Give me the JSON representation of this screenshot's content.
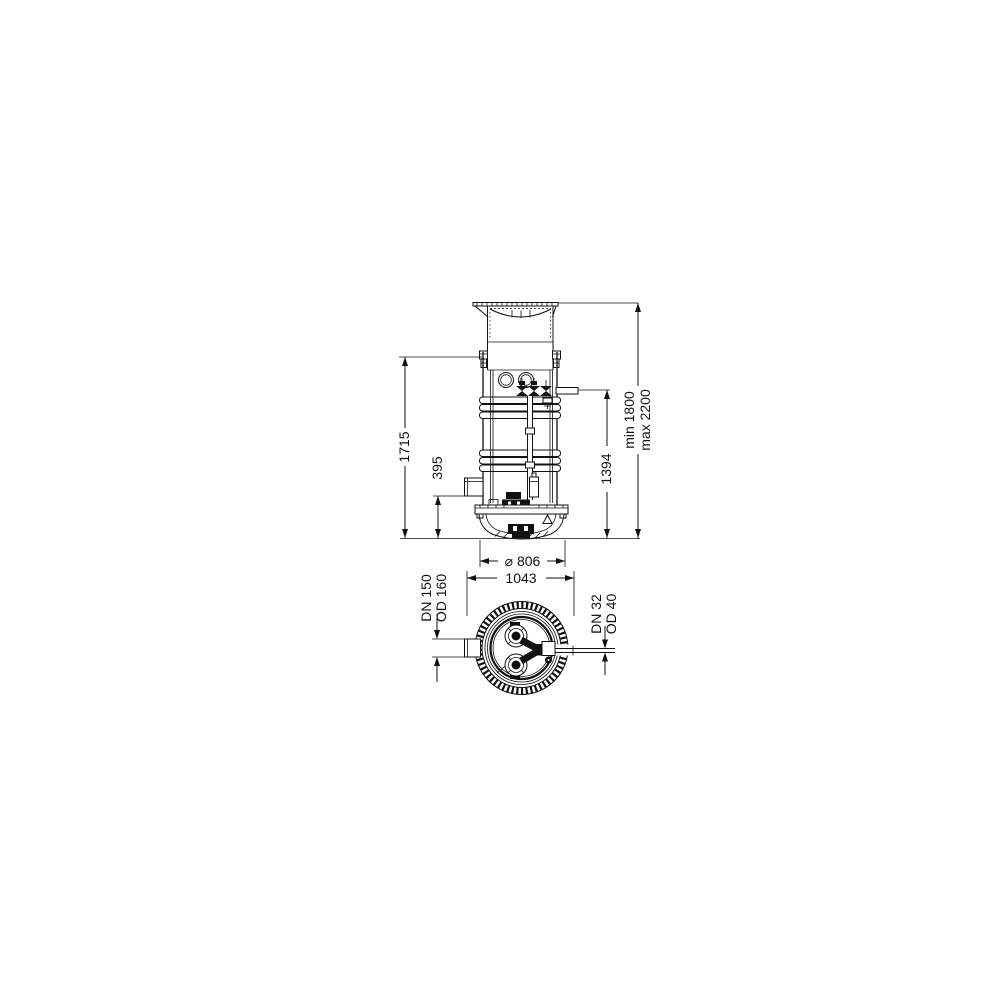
{
  "drawing": {
    "background": "#ffffff",
    "line_color": "#111111",
    "elevation": {
      "dim_shaft_height": "1715",
      "dim_inlet_height": "395",
      "dim_outlet_height": "1394",
      "dim_install_min": "min 1800",
      "dim_install_max": "max 2200",
      "dim_base_diameter": "⌀ 806"
    },
    "plan": {
      "dim_top_width": "1043",
      "inlet_nominal": "DN 150",
      "inlet_outer": "OD 160",
      "pressure_nominal": "DN 32",
      "pressure_outer": "OD 40"
    }
  }
}
